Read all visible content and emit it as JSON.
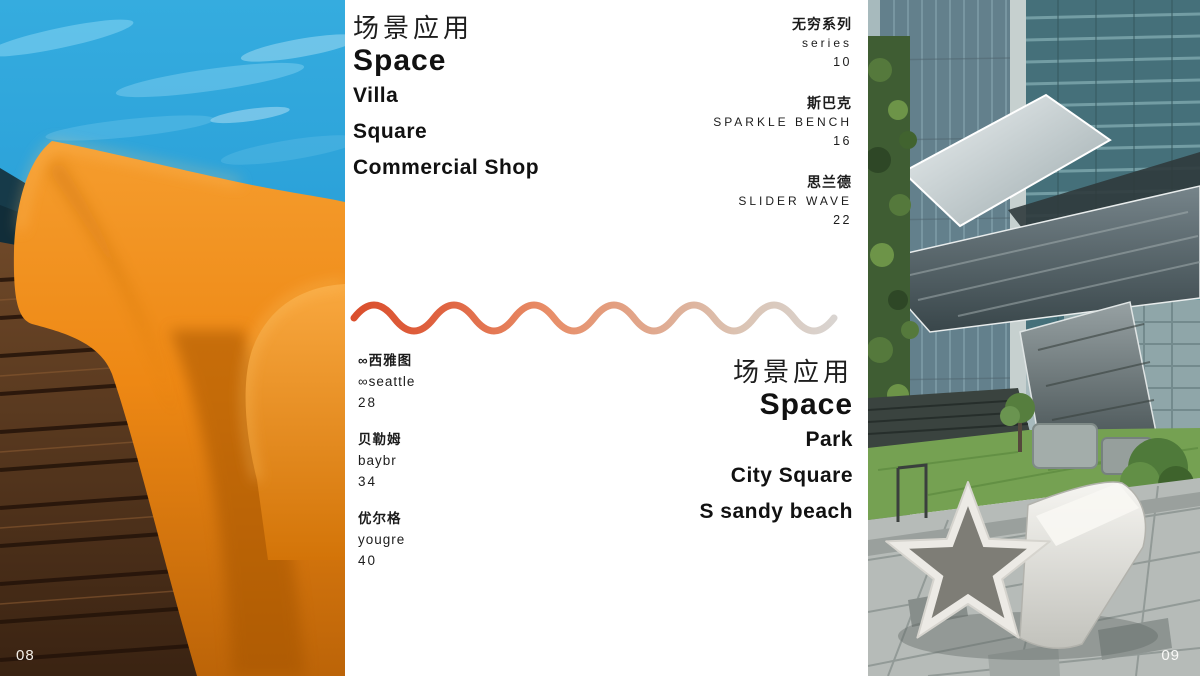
{
  "spread": {
    "left_page_number": "08",
    "right_page_number": "09"
  },
  "toc_top_left": {
    "title_cn": "场景应用",
    "title_en": "Space",
    "items": [
      "Villa",
      "Square",
      "Commercial Shop"
    ]
  },
  "toc_top_right": {
    "entries": [
      {
        "cn": "无穷系列",
        "en": "series",
        "page": "10"
      },
      {
        "cn": "斯巴克",
        "en": "SPARKLE BENCH",
        "page": "16"
      },
      {
        "cn": "思兰德",
        "en": "SLIDER WAVE",
        "page": "22"
      }
    ]
  },
  "toc_bottom_left": {
    "entries": [
      {
        "cn": "∞西雅图",
        "en": "∞seattle",
        "page": "28"
      },
      {
        "cn": "贝勒姆",
        "en": "baybr",
        "page": "34"
      },
      {
        "cn": "优尔格",
        "en": "yougre",
        "page": "40"
      }
    ]
  },
  "toc_bottom_right": {
    "title_cn": "场景应用",
    "title_en": "Space",
    "items": [
      "Park",
      "City Square",
      "S sandy beach"
    ]
  },
  "colors": {
    "wave_start": "#da4e2c",
    "wave_mid": "#e88d67",
    "wave_end": "#d9d5d2",
    "chair_orange": "#ed8513",
    "pool_blue": "#2fa7e0"
  }
}
